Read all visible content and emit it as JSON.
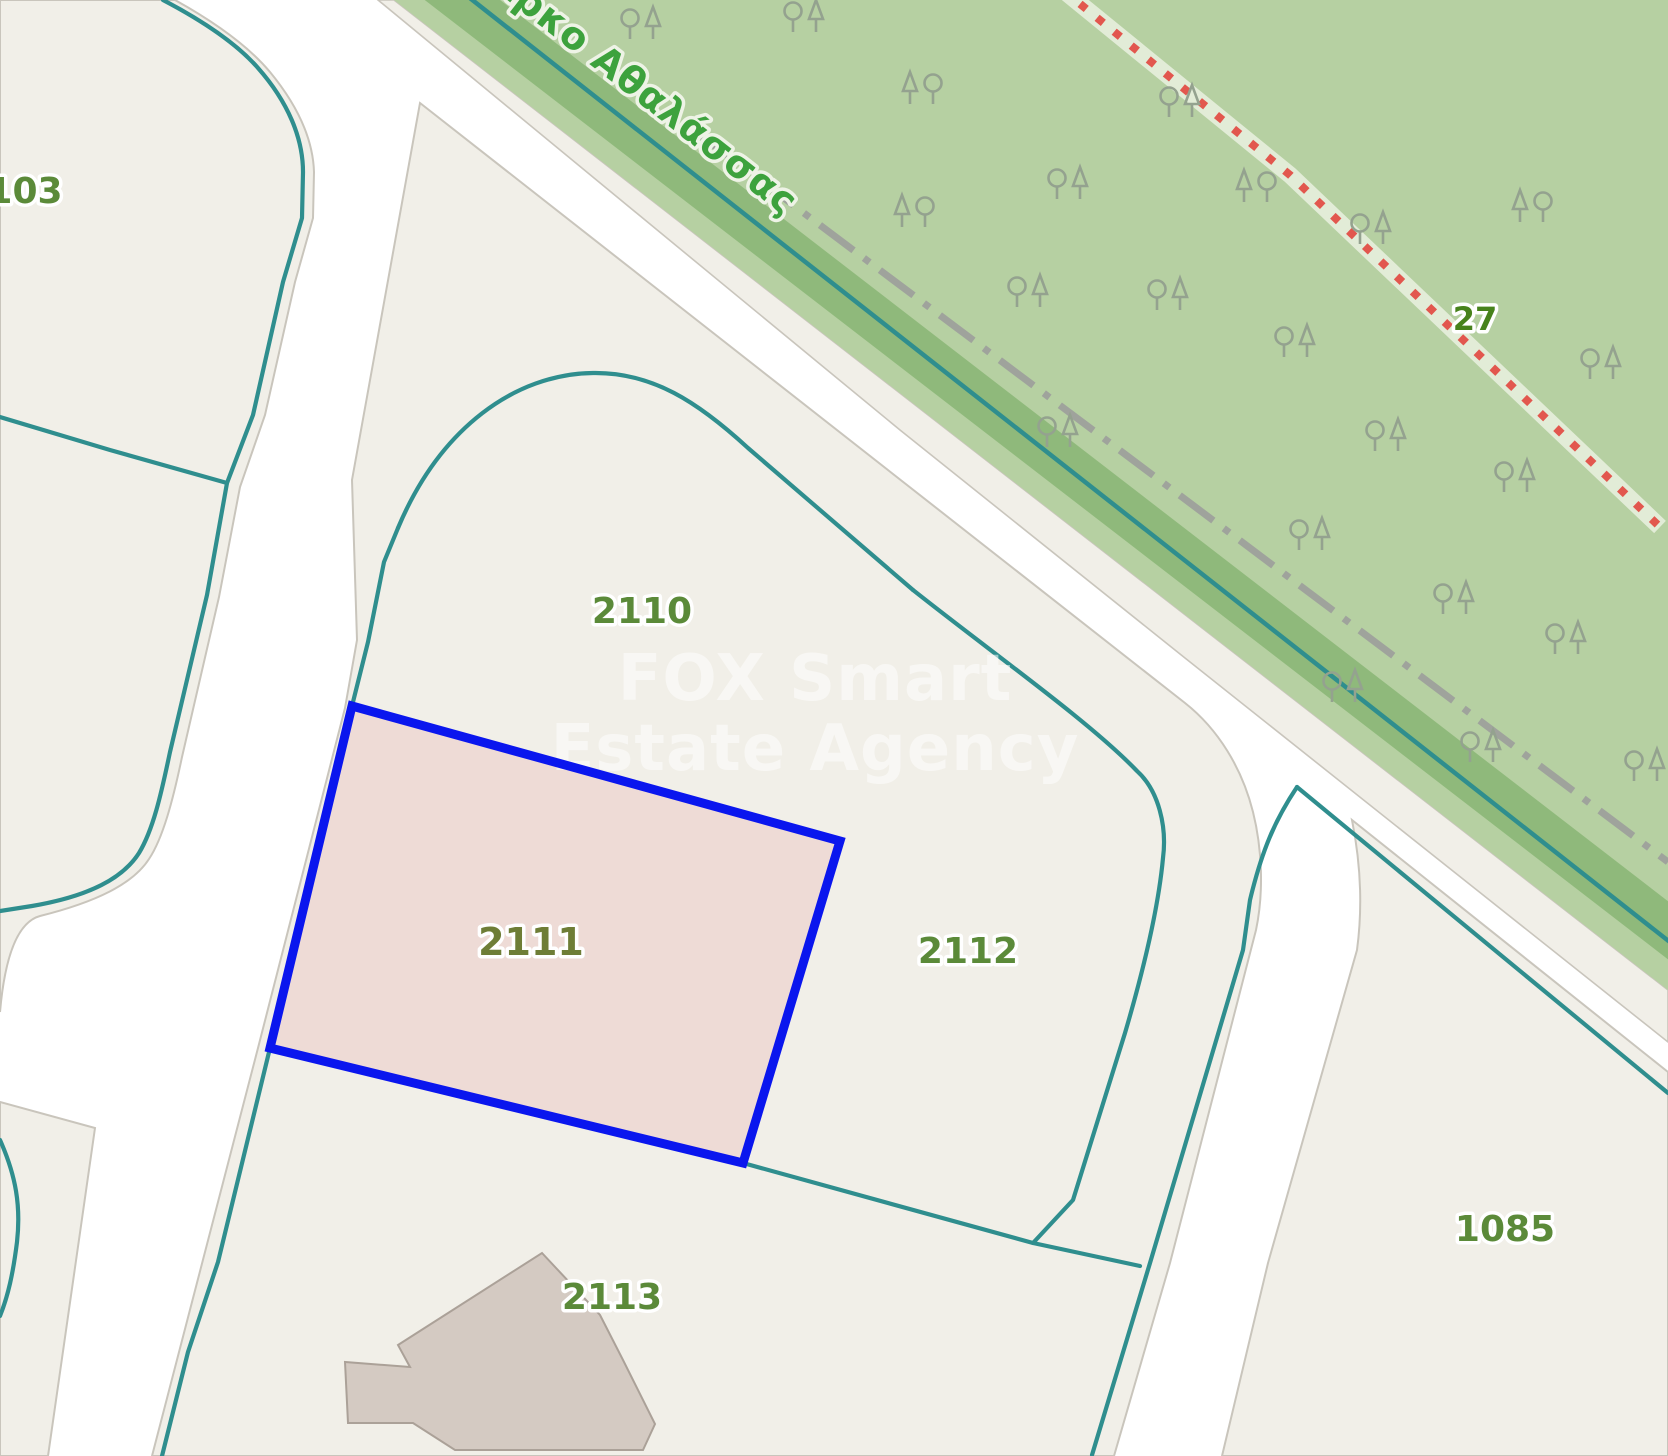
{
  "map": {
    "type": "cadastral-parcel-map",
    "watermark": {
      "line1": "FOX Smart",
      "line2": "Estate Agency"
    },
    "park": {
      "name": "Πάρκο Αθαλάσσας",
      "trail_label": "27"
    },
    "selected_parcel": "2111",
    "parcels": [
      {
        "label": "103"
      },
      {
        "label": "2110"
      },
      {
        "label": "2111",
        "selected": true
      },
      {
        "label": "2112"
      },
      {
        "label": "2113"
      },
      {
        "label": "1085"
      }
    ],
    "icons": [
      "tree-pair-icon"
    ],
    "colors": {
      "parcel_boundary_teal": "#2f8e8e",
      "highlight_border_blue": "#0a16ee",
      "highlight_fill_pink": "#eedbd6",
      "park_fill_green": "#b6d0a2",
      "park_band_green": "#8fb97b",
      "label_green": "#5b8a39",
      "trail_label_green": "#47821c",
      "park_name_green": "#3da23d",
      "trail_dots_red": "#e2574e",
      "boundary_dashdot_gray": "#9b9b9b",
      "road_white": "#ffffff",
      "block_beige": "#f1efe8",
      "building_gray": "#d4cac2",
      "watermark_white": "#ffffff"
    }
  }
}
